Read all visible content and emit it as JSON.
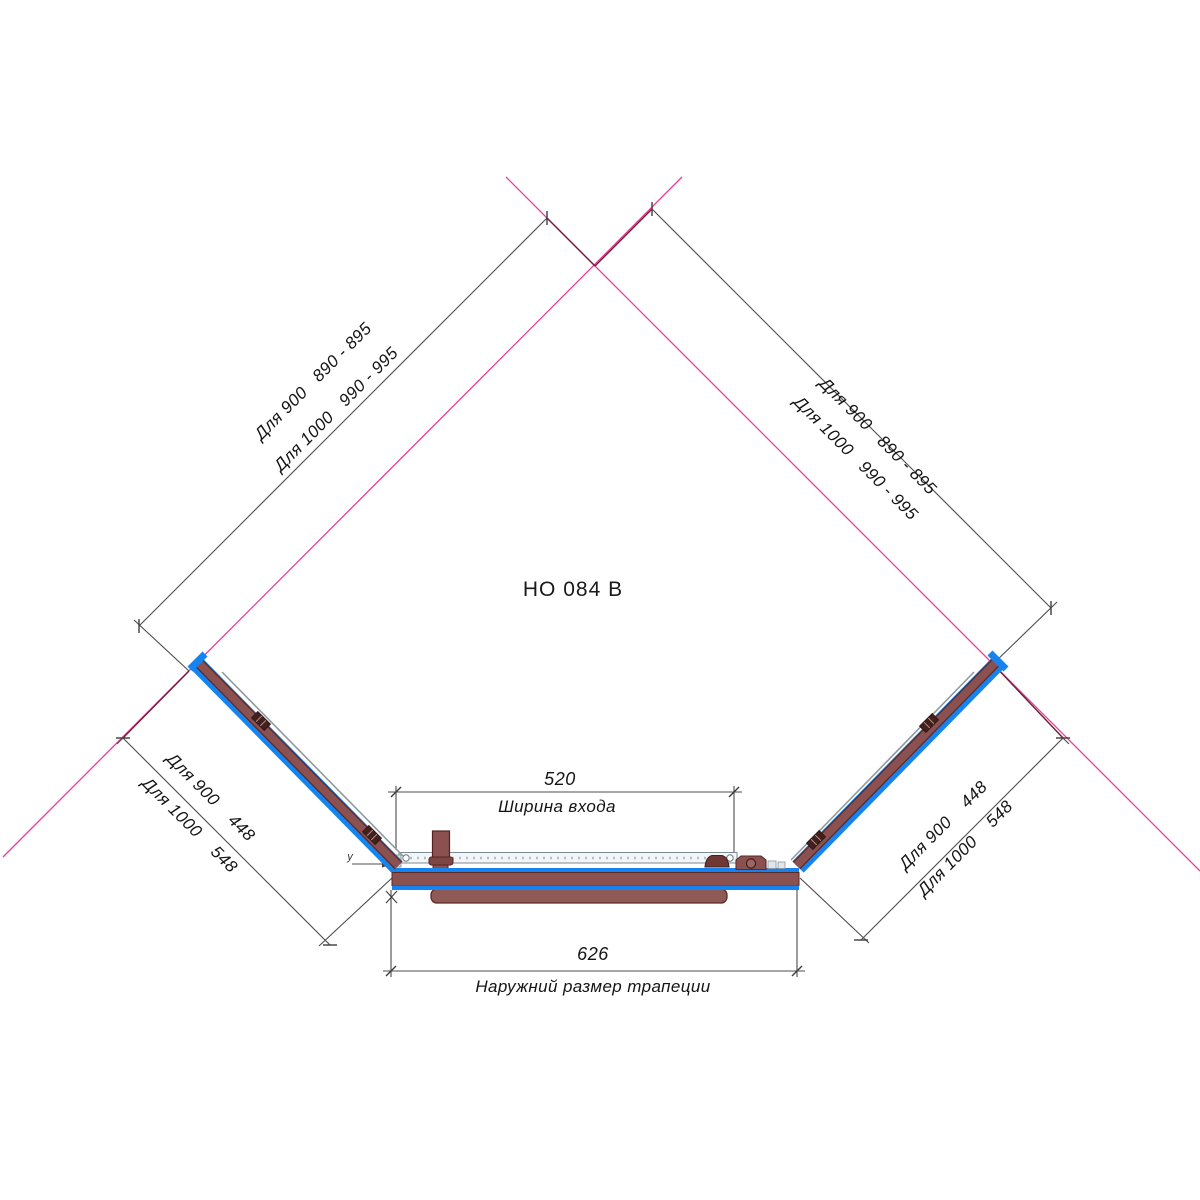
{
  "title": "НО 084 В",
  "dimensions": {
    "upper_left": {
      "row1": "Для 900   890 - 895",
      "row2": "Для 1000   990 - 995"
    },
    "upper_right": {
      "row1": "Для 900   890 - 895",
      "row2": "Для 1000   990 - 995"
    },
    "lower_left": {
      "row1": "Для 900    448",
      "row2": "Для 1000    548"
    },
    "lower_right": {
      "row1": "Для 900    448",
      "row2": "Для 1000    548"
    },
    "entry_width": {
      "value": "520",
      "label": "Ширина входа"
    },
    "outer_width": {
      "value": "626",
      "label": "Наружний размер трапеции"
    }
  },
  "markers": {
    "corner_leader": "y"
  },
  "colors": {
    "wall_line": "#ee3a9c",
    "overlap_line": "#6b2138",
    "dimension_line": "#4c4c4c",
    "frame_blue": "#1583f0",
    "profile_brown": "#8a5150",
    "profile_dark": "#5a2a28",
    "text": "#141414"
  }
}
